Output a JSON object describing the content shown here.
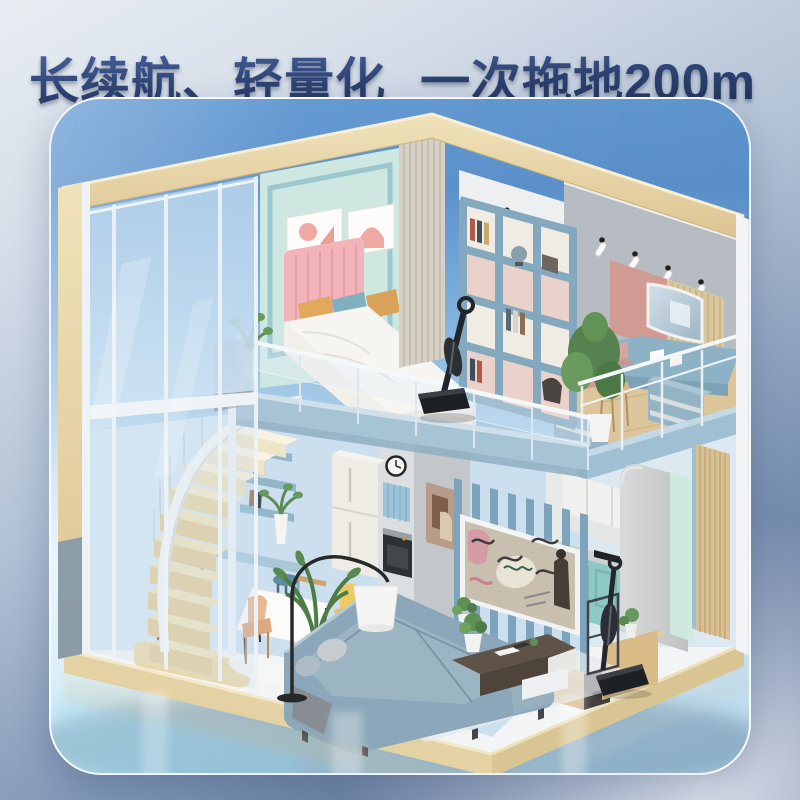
{
  "headline": {
    "part1": "长续航、轻量化",
    "part2": "一次拖地200m",
    "superscript": "2",
    "full_text": "长续航、轻量化 一次拖地200m²"
  },
  "colors": {
    "headline_text": "#2c4271",
    "background_top_left": "#e9edf2",
    "background_bottom_left": "#53668b",
    "card_sky_blue": "#5e93cd",
    "card_glossy_floor": "#d8eef9",
    "wood_beam": "#e9d8ae",
    "slab_blue": "#a6c4d4",
    "mint_wall": "#cfe7e1",
    "pink_headboard": "#f2b4b9",
    "bookshelf_blue": "#84a9bf",
    "kitchen_teal": "#8ec9c6",
    "sofa_blue_grey": "#8ca7b9",
    "product_black": "#1d2125"
  },
  "scene": {
    "style": "isometric 3D loft-apartment cutaway render",
    "rooms": [
      "bedroom loft",
      "study loft",
      "living room",
      "dining area",
      "kitchen",
      "winding staircase"
    ],
    "products": [
      {
        "label": "cordless wet-dry vacuum mop standing on loft floor"
      },
      {
        "label": "cordless wet-dry vacuum mop with stand on kitchen floor"
      }
    ]
  }
}
